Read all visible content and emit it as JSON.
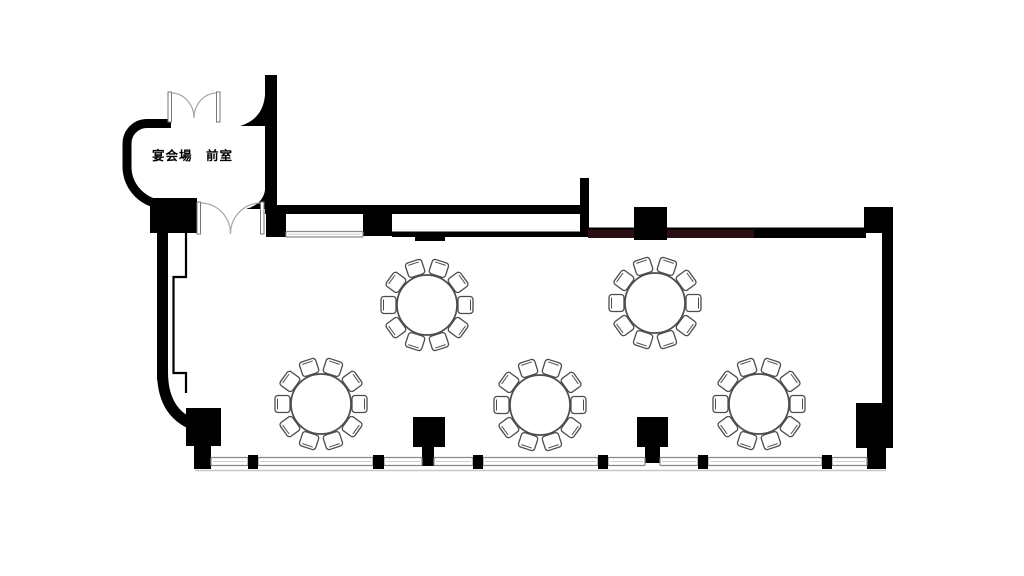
{
  "plan": {
    "room_label": "宴会場　前室",
    "colors": {
      "wall": "#000000",
      "accent_wall": "#2b0e11",
      "window_stroke": "#8a8a8a",
      "furniture_stroke": "#4d4d4d",
      "door_arc": "#a8a8a8",
      "shadow": "#c8c8c8",
      "background": "#ffffff",
      "label_color": "#000000"
    },
    "table_style": {
      "radius": 30,
      "chairs_per_table": 10,
      "chair_distance": 38.5,
      "chair_w": 17,
      "chair_h": 15,
      "angle_offset_deg": 0
    },
    "tables": [
      {
        "cx": 427,
        "cy": 305
      },
      {
        "cx": 655,
        "cy": 303
      },
      {
        "cx": 321,
        "cy": 404
      },
      {
        "cx": 540,
        "cy": 405
      },
      {
        "cx": 759,
        "cy": 404
      }
    ],
    "pillars": [
      {
        "x": 150,
        "y": 198,
        "w": 47,
        "h": 35
      },
      {
        "x": 266,
        "y": 213,
        "w": 20,
        "h": 24
      },
      {
        "x": 363,
        "y": 209,
        "w": 29,
        "h": 27
      },
      {
        "x": 634,
        "y": 207,
        "w": 33,
        "h": 33
      },
      {
        "x": 864,
        "y": 207,
        "w": 29,
        "h": 26
      },
      {
        "x": 856,
        "y": 403,
        "w": 37,
        "h": 45
      },
      {
        "x": 867,
        "y": 448,
        "w": 19,
        "h": 21
      },
      {
        "x": 186,
        "y": 408,
        "w": 35,
        "h": 38
      },
      {
        "x": 194,
        "y": 446,
        "w": 17,
        "h": 23
      },
      {
        "x": 413,
        "y": 417,
        "w": 32,
        "h": 30
      },
      {
        "x": 422,
        "y": 447,
        "w": 12,
        "h": 19
      },
      {
        "x": 637,
        "y": 417,
        "w": 31,
        "h": 30
      },
      {
        "x": 645,
        "y": 447,
        "w": 15,
        "h": 16
      }
    ],
    "mullions": [
      {
        "x": 248,
        "y": 455,
        "w": 10,
        "h": 14
      },
      {
        "x": 373,
        "y": 455,
        "w": 11,
        "h": 14
      },
      {
        "x": 473,
        "y": 455,
        "w": 10,
        "h": 14
      },
      {
        "x": 598,
        "y": 455,
        "w": 10,
        "h": 14
      },
      {
        "x": 698,
        "y": 455,
        "w": 10,
        "h": 14
      },
      {
        "x": 822,
        "y": 455,
        "w": 10,
        "h": 14
      }
    ],
    "windows": [
      {
        "x": 286,
        "y": 231.5,
        "w": 77,
        "h": 5.5
      },
      {
        "x": 211,
        "y": 457.5,
        "w": 37,
        "h": 8
      },
      {
        "x": 258,
        "y": 457.5,
        "w": 115,
        "h": 8
      },
      {
        "x": 384,
        "y": 457.5,
        "w": 38,
        "h": 8
      },
      {
        "x": 434,
        "y": 457.5,
        "w": 39,
        "h": 8
      },
      {
        "x": 483,
        "y": 457.5,
        "w": 115,
        "h": 8
      },
      {
        "x": 608,
        "y": 457.5,
        "w": 37,
        "h": 8
      },
      {
        "x": 660,
        "y": 457.5,
        "w": 38,
        "h": 8
      },
      {
        "x": 708,
        "y": 457.5,
        "w": 114,
        "h": 8
      },
      {
        "x": 832,
        "y": 457.5,
        "w": 35,
        "h": 8
      }
    ],
    "window_baseline": {
      "x1": 195,
      "y": 470.5,
      "x2": 886
    },
    "doors": [
      {
        "jambs": [
          {
            "x": 168,
            "y": 92,
            "w": 3.5,
            "h": 30
          },
          {
            "x": 216.5,
            "y": 92,
            "w": 3.5,
            "h": 30
          }
        ],
        "arcs": [
          "M171.5,93 A23,25 0 0 1 194,118",
          "M216.5,93 A23,25 0 0 0 194,118"
        ]
      },
      {
        "jambs": [
          {
            "x": 197,
            "y": 202,
            "w": 3.5,
            "h": 32
          },
          {
            "x": 260.5,
            "y": 202,
            "w": 3.5,
            "h": 32
          }
        ],
        "arcs": [
          "M200.5,203 A30,31 0 0 1 230.5,234",
          "M260.5,203 A30,31 0 0 0 230.5,234"
        ]
      }
    ]
  }
}
